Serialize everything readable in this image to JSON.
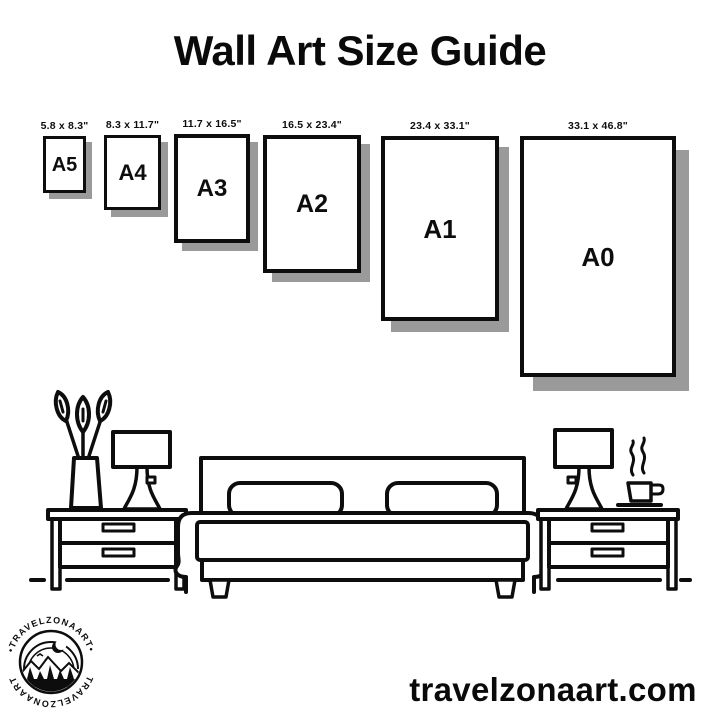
{
  "page": {
    "title": "Wall Art Size Guide",
    "website": "travelzonaart.com"
  },
  "sizes": [
    {
      "label": "A5",
      "dimensions": "5.8 x 8.3\""
    },
    {
      "label": "A4",
      "dimensions": "8.3 x 11.7\""
    },
    {
      "label": "A3",
      "dimensions": "11.7 x 16.5\""
    },
    {
      "label": "A2",
      "dimensions": "16.5 x 23.4\""
    },
    {
      "label": "A1",
      "dimensions": "23.4 x 33.1\""
    },
    {
      "label": "A0",
      "dimensions": "33.1 x 46.8\""
    }
  ],
  "logo": {
    "text_top": "•TRAVELZONAART•",
    "text_bottom": "TRAVELZONAART"
  },
  "colors": {
    "ink": "#0d0d0d",
    "frame_shadow": "#9a9a9a",
    "background": "#ffffff"
  },
  "illustration": {
    "icons": [
      "vase-with-leaves-icon",
      "table-lamp-icon",
      "nightstand-icon",
      "double-bed-icon",
      "pillow-icon",
      "coffee-cup-icon",
      "steam-icon",
      "floor-line-icon",
      "mountain-badge-icon"
    ]
  }
}
